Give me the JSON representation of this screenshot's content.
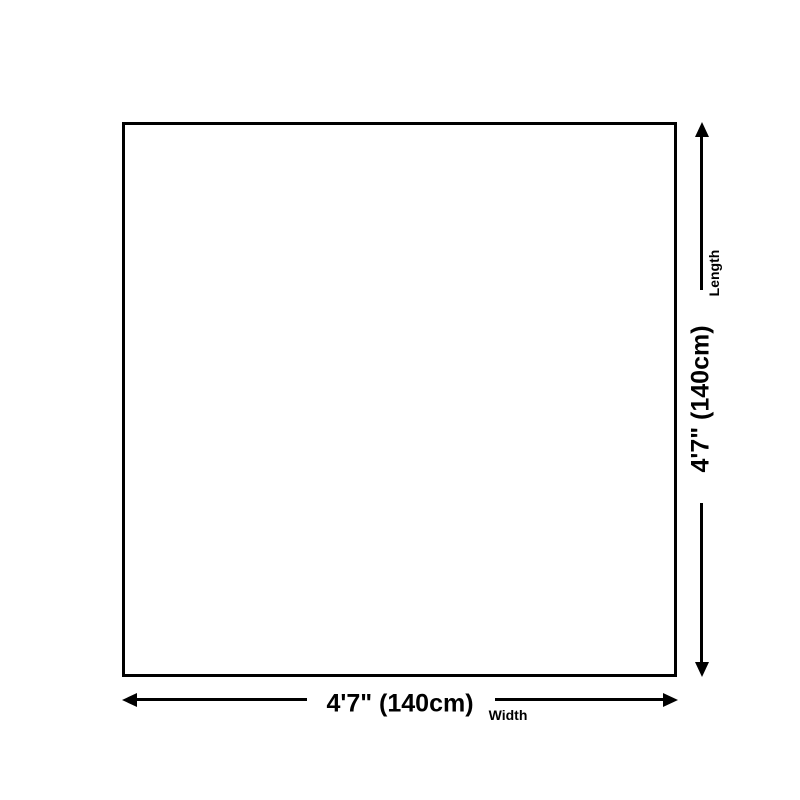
{
  "colors": {
    "line": "#000000",
    "background": "#ffffff"
  },
  "diagram": {
    "shape": "square-outline",
    "length": {
      "value": "4'7\" (140cm)",
      "label": "Length"
    },
    "width": {
      "value": "4'7\" (140cm)",
      "label": "Width"
    }
  },
  "icons": {
    "vertical_axis": [
      "arrow-up-icon",
      "arrow-down-icon"
    ],
    "horizontal_axis": [
      "arrow-left-icon",
      "arrow-right-icon"
    ]
  }
}
